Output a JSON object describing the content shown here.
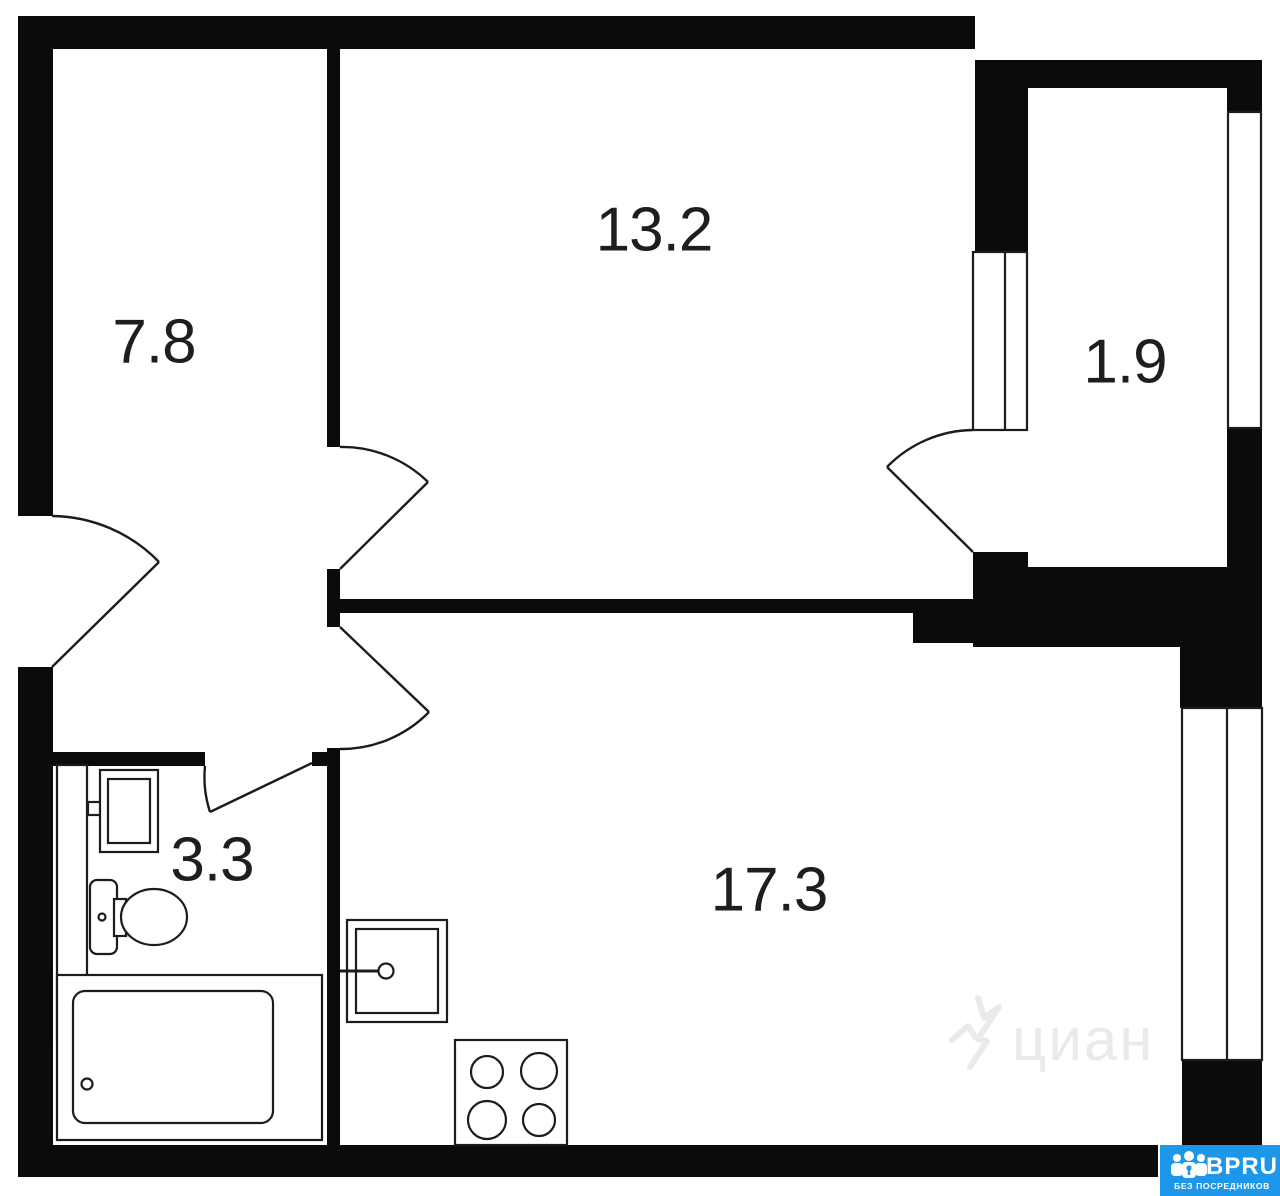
{
  "plan": {
    "type": "apartment-floor-plan",
    "rooms": [
      {
        "name": "hallway",
        "area": "7.8"
      },
      {
        "name": "room",
        "area": "13.2"
      },
      {
        "name": "balcony",
        "area": "1.9"
      },
      {
        "name": "bathroom",
        "area": "3.3"
      },
      {
        "name": "living-room",
        "area": "17.3"
      }
    ],
    "fixtures": [
      "bathroom-sink",
      "toilet",
      "bathtub",
      "kitchen-sink",
      "stove-4-burners"
    ],
    "doors": [
      "entrance-door",
      "room-door",
      "living-room-door",
      "bathroom-door",
      "balcony-door"
    ],
    "windows": [
      "room-balcony-window",
      "balcony-window",
      "living-room-window"
    ]
  },
  "watermark": {
    "text": "циан"
  },
  "logo": {
    "brand": "BPRU",
    "tagline": "БЕЗ ПОСРЕДНИКОВ",
    "background": "#1d97ea"
  },
  "colors": {
    "walls": "#0b0b0b",
    "background": "#ffffff",
    "lines": "#1c1c1c",
    "label": "#1e1e1e"
  }
}
